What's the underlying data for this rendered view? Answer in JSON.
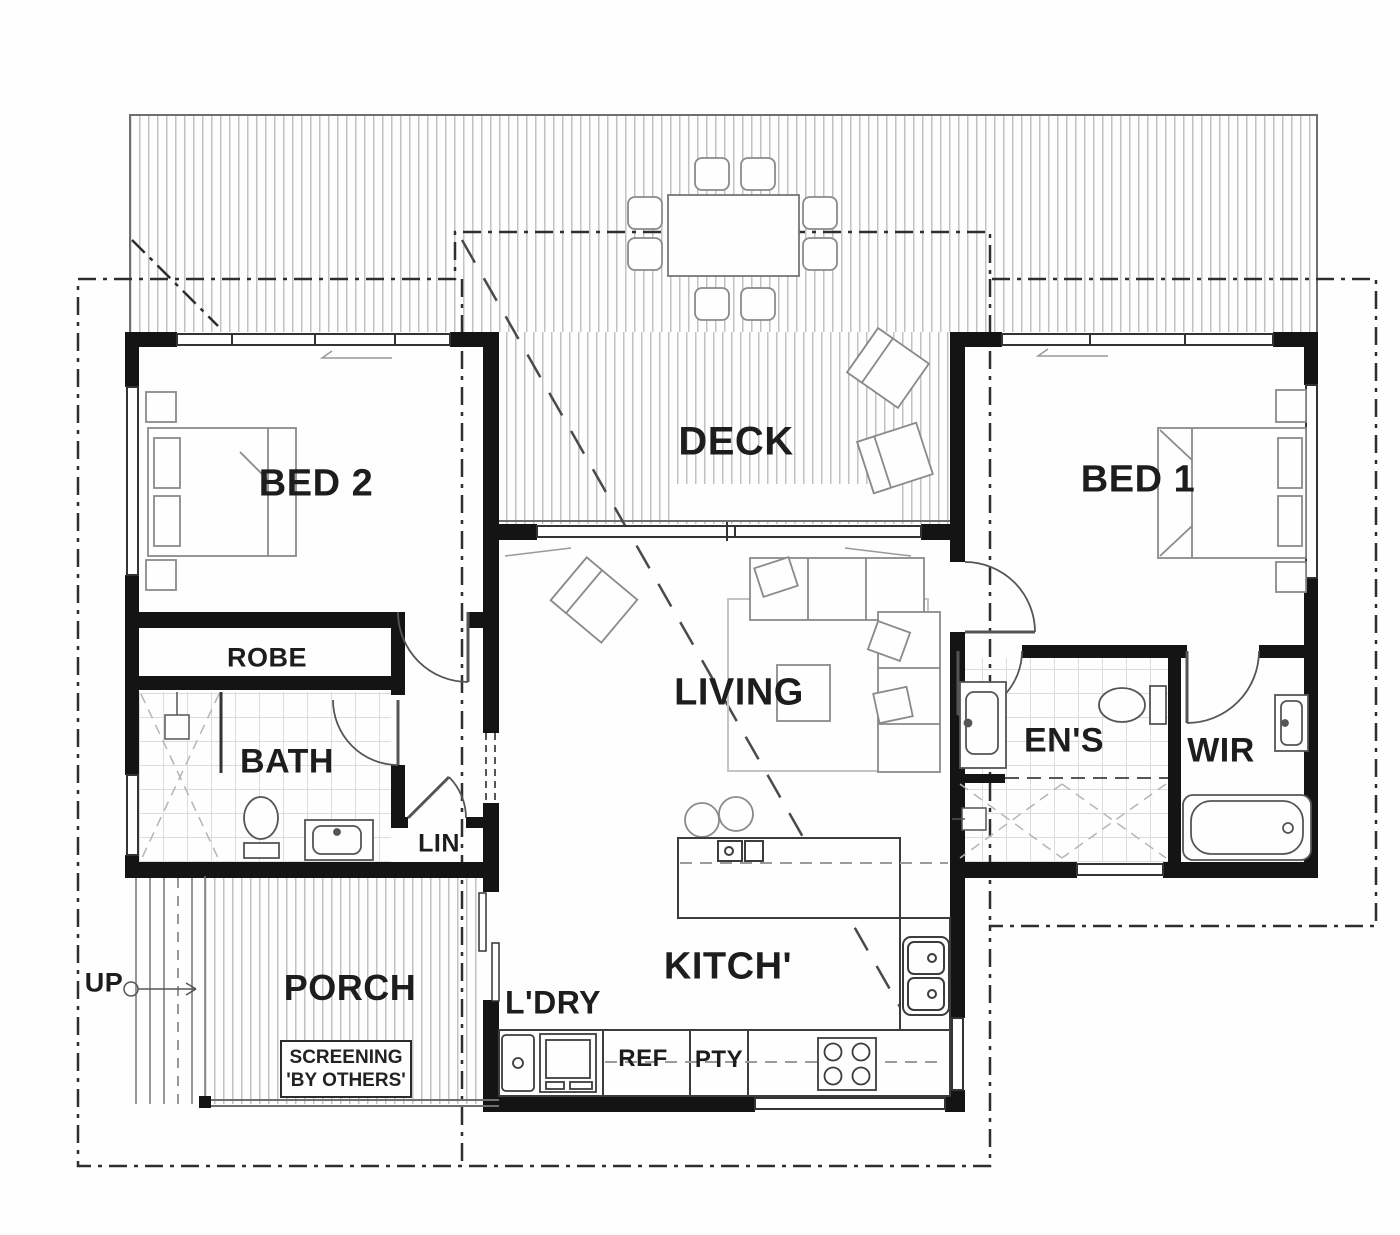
{
  "title": "House floor plan",
  "labels": {
    "deck": "DECK",
    "bed2": "BED 2",
    "bed1": "BED 1",
    "robe": "ROBE",
    "bath": "BATH",
    "lin": "LIN",
    "living": "LIVING",
    "ens": "EN'S",
    "wir": "WIR",
    "porch": "PORCH",
    "ldry": "L'DRY",
    "kitch": "KITCH'",
    "ref": "REF",
    "pty": "PTY"
  },
  "annotations": {
    "up": "UP",
    "screening_line1": "SCREENING",
    "screening_line2": "'BY OTHERS'"
  },
  "colors": {
    "background": "#fefefe",
    "wall": "#141414",
    "linework": "#555555",
    "hatch": "#c2c2c2",
    "text": "#1d1d1d"
  }
}
